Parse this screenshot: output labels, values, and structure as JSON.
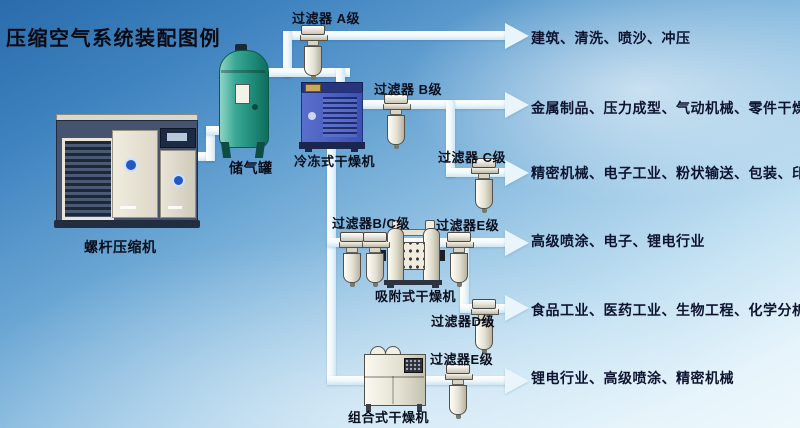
{
  "title": "压缩空气系统装配图例",
  "labels": {
    "compressor": "螺杆压缩机",
    "tank": "储气罐",
    "cold_dryer": "冷冻式干燥机",
    "adsorption_dryer": "吸附式干燥机",
    "combined_dryer": "组合式干燥机",
    "filter_a": "过滤器 A级",
    "filter_b": "过滤器 B级",
    "filter_c": "过滤器 C级",
    "filter_bc": "过滤器B/C级",
    "filter_e_mid": "过滤器E级",
    "filter_d": "过滤器D级",
    "filter_e_bottom": "过滤器E级"
  },
  "applications": [
    "建筑、清洗、喷沙、冲压",
    "金属制品、压力成型、气动机械、零件干燥",
    "精密机械、电子工业、粉状输送、包装、印刷",
    "高级喷涂、电子、锂电行业",
    "食品工业、医药工业、生物工程、化学分析",
    "锂电行业、高级喷涂、精密机械"
  ],
  "colors": {
    "sky_top": "#2a6cac",
    "sky_bottom": "#eef8fc",
    "pipe": "#eef7fb",
    "text_dark": "#0d1430",
    "tank_green": "#2a9c89",
    "dryer_blue": "#4a5fc0"
  }
}
